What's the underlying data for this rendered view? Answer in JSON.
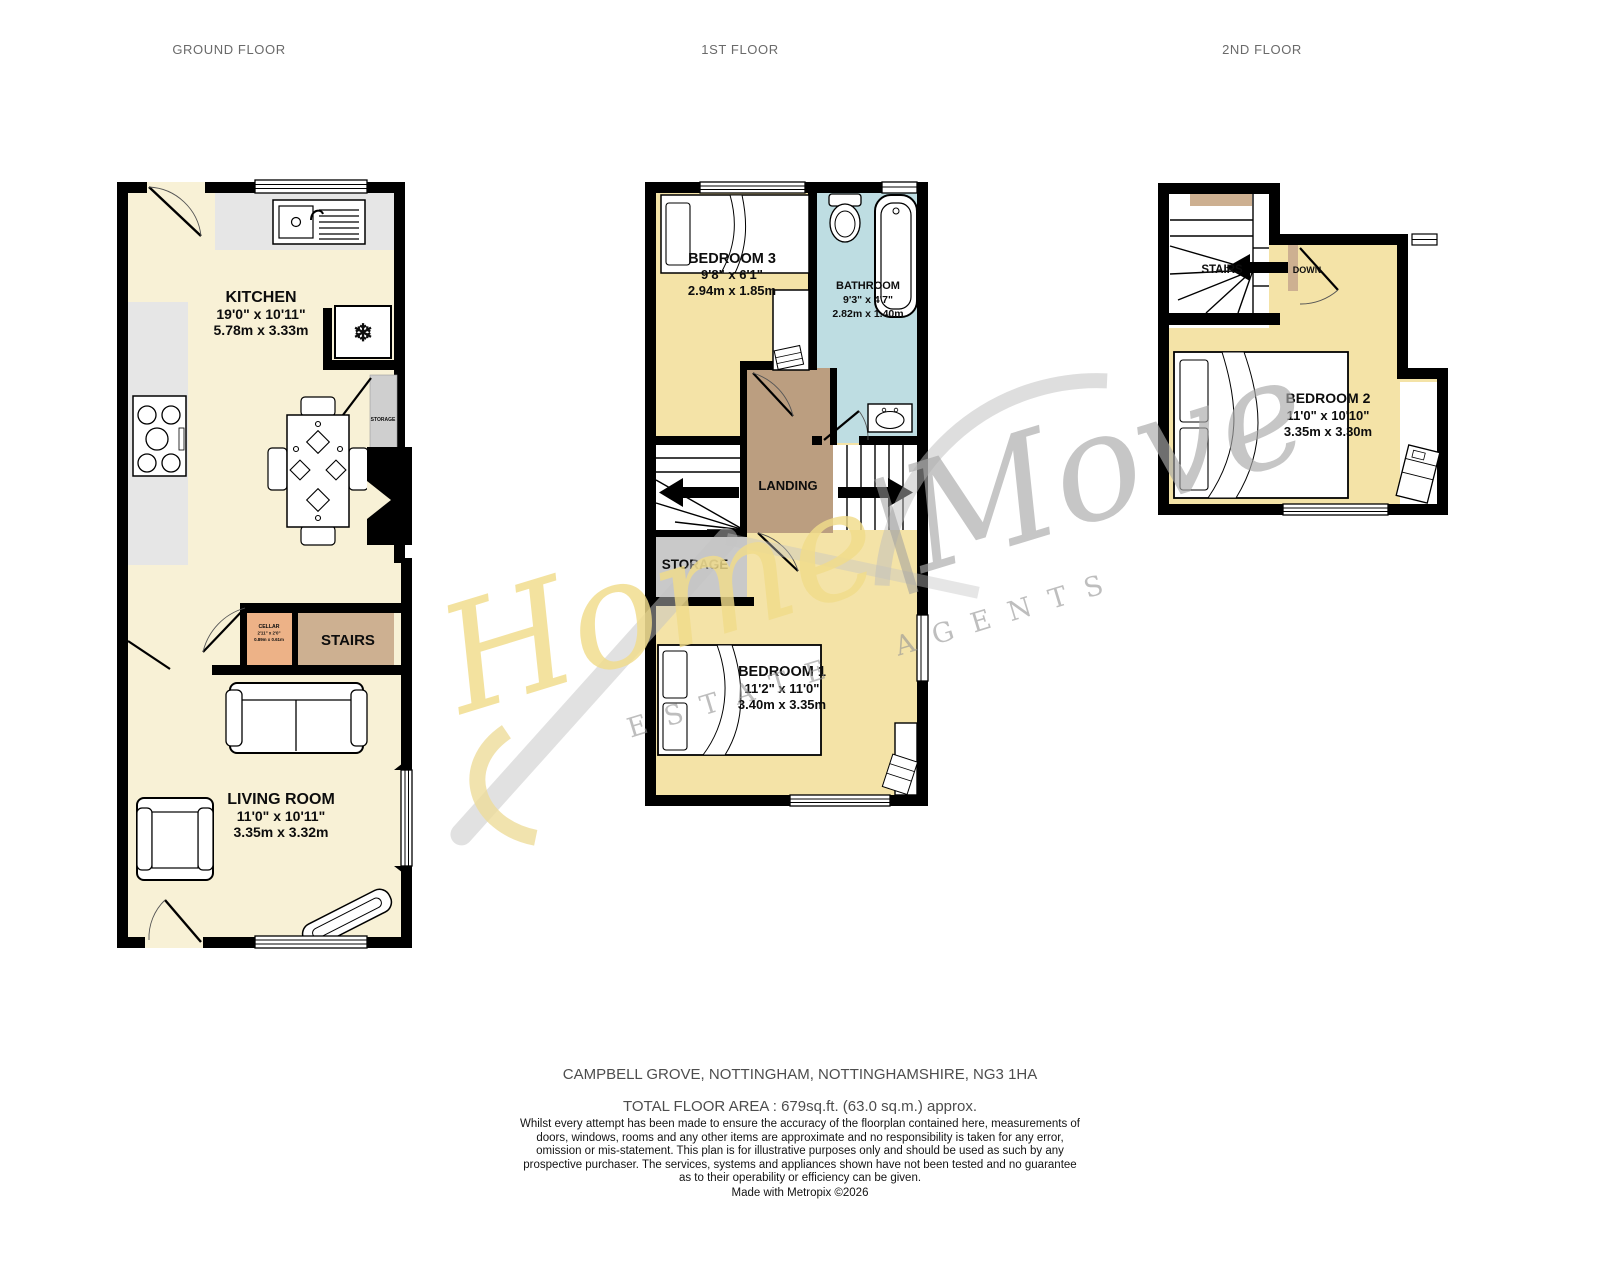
{
  "floor_labels": {
    "ground": "GROUND FLOOR",
    "first": "1ST FLOOR",
    "second": "2ND FLOOR"
  },
  "rooms": {
    "kitchen": {
      "name": "KITCHEN",
      "imperial": "19'0\" x 10'11\"",
      "metric": "5.78m x 3.33m"
    },
    "living_room": {
      "name": "LIVING ROOM",
      "imperial": "11'0\" x 10'11\"",
      "metric": "3.35m x 3.32m"
    },
    "cellar": {
      "name": "CELLAR",
      "imperial": "2'11\" x 2'0\"",
      "metric": "0.89m x 0.61m"
    },
    "stairs_ground": {
      "name": "STAIRS"
    },
    "kitchen_storage": {
      "name": "STORAGE"
    },
    "bedroom3": {
      "name": "BEDROOM 3",
      "imperial": "9'8\" x 6'1\"",
      "metric": "2.94m x 1.85m"
    },
    "bathroom": {
      "name": "BATHROOM",
      "imperial": "9'3\" x 4'7\"",
      "metric": "2.82m x 1.40m"
    },
    "landing": {
      "name": "LANDING"
    },
    "storage": {
      "name": "STORAGE"
    },
    "bedroom1": {
      "name": "BEDROOM 1",
      "imperial": "11'2\" x 11'0\"",
      "metric": "3.40m x 3.35m"
    },
    "bedroom2": {
      "name": "BEDROOM 2",
      "imperial": "11'0\" x 10'10\"",
      "metric": "3.35m x 3.30m"
    },
    "stairs_second": {
      "name": "STAIRS",
      "direction": "DOWN"
    }
  },
  "watermark": {
    "part1": "Home",
    "divider": "|",
    "part2": "Move",
    "tagline": "ESTATE AGENTS"
  },
  "footer": {
    "address": "CAMPBELL GROVE, NOTTINGHAM, NOTTINGHAMSHIRE, NG3 1HA",
    "total_area": "TOTAL FLOOR AREA : 679sq.ft. (63.0 sq.m.) approx.",
    "disclaimer": "Whilst every attempt has been made to ensure the accuracy of the floorplan contained here, measurements of doors, windows, rooms and any other items are approximate and no responsibility is taken for any error, omission or mis-statement. This plan is for illustrative purposes only and should be used as such by any prospective purchaser. The services, systems and appliances shown have not been tested and no guarantee as to their operability or efficiency can be given.",
    "credit": "Made with Metropix ©2026"
  },
  "colors": {
    "room_cream": "#f8f1d6",
    "room_yellow": "#f4e3a7",
    "bathroom_blue": "#bedde2",
    "landing_tan": "#bb9e80",
    "stairs_tan": "#cdb091",
    "cellar_orange": "#edb287",
    "storage_grey": "#c9c9c9",
    "counter_grey": "#e6e6e6",
    "wall_black": "#000000"
  }
}
